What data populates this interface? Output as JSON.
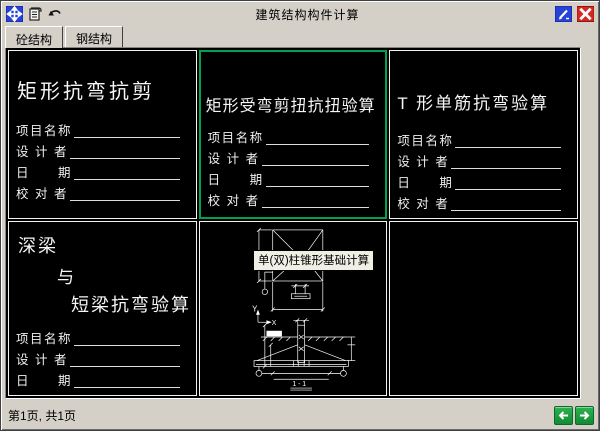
{
  "window": {
    "title": "建筑结构构件计算"
  },
  "titlebar": {
    "icons": [
      "move-icon",
      "scroll-icon",
      "undo-icon",
      "edit-icon",
      "close-icon"
    ]
  },
  "tabs": {
    "concrete": "砼结构",
    "steel": "钢结构"
  },
  "fields": [
    "项目名称",
    "设 计 者",
    "日　　期",
    "校 对 者"
  ],
  "cards": {
    "rect_bend_shear": {
      "title": "矩形抗弯抗剪"
    },
    "rect_torsion": {
      "title": "矩形受弯剪扭抗扭验算",
      "selected": true
    },
    "t_single_rebar": {
      "title": "T 形单筋抗弯验算"
    },
    "deep_beam": {
      "line1": "深梁",
      "line2": "与",
      "line3": "短梁抗弯验算"
    }
  },
  "tooltip": {
    "text": "单(双)柱锥形基础计算"
  },
  "drawing": {
    "axis_y": "Y",
    "axis_x": "X",
    "section_label": "1 - 1"
  },
  "statusbar": {
    "page_info": "第1页, 共1页"
  },
  "colors": {
    "chrome_gray": "#d4d0c8",
    "canvas_black": "#000000",
    "selection_green": "#00a34d",
    "nav_green": "#1b9e43",
    "icon_blue": "#2743d6",
    "close_red": "#d6281e",
    "tooltip_bg": "#f0efe6"
  }
}
